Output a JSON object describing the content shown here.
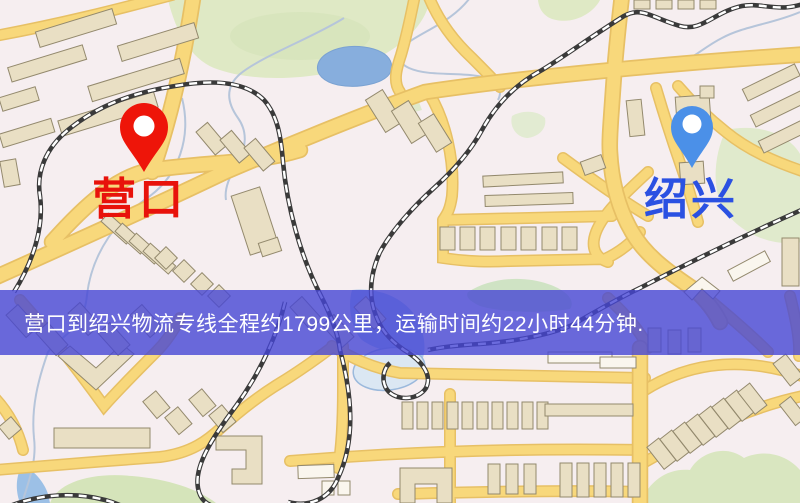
{
  "map": {
    "origin_marker": {
      "label": "营口",
      "icon": "red-location-pin-icon",
      "pin_color": "#ee1509",
      "label_color": "#e8120b"
    },
    "destination_marker": {
      "label": "绍兴",
      "icon": "blue-location-pin-icon",
      "pin_color": "#4b90e8",
      "label_color": "#2b51e2"
    },
    "banner": {
      "text": "营口到绍兴物流专线全程约1799公里，运输时间约22小时44分钟.",
      "background_color": "#4646d4",
      "text_color": "#ffffff"
    },
    "legend_colors": {
      "background": "#f6eef0",
      "road": "#f8d87b",
      "road_casing": "#e7c065",
      "railway": "#3a3a3a",
      "park": "#dde9c9",
      "water": "#87aedd",
      "building": "#e9dfc4"
    }
  }
}
